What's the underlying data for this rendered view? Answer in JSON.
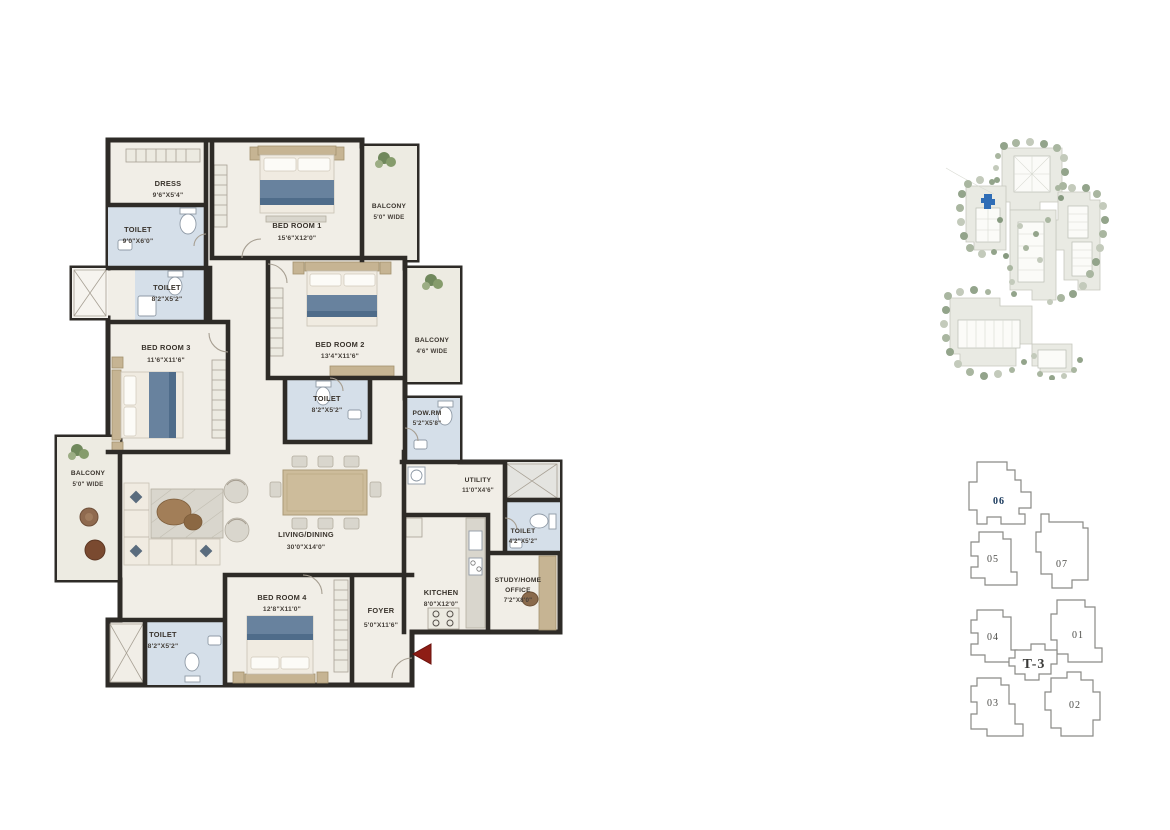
{
  "floorplan": {
    "rooms": [
      {
        "name": "DRESS",
        "dims": "9'6\"X5'4\""
      },
      {
        "name": "TOILET",
        "dims": "9'0\"X6'0\""
      },
      {
        "name": "BED ROOM 1",
        "dims": "15'6\"X12'0\""
      },
      {
        "name": "BALCONY",
        "dims": "5'0\" WIDE"
      },
      {
        "name": "TOILET",
        "dims": "8'2\"X5'2\""
      },
      {
        "name": "BED ROOM 3",
        "dims": "11'6\"X11'6\""
      },
      {
        "name": "BED ROOM 2",
        "dims": "13'4\"X11'6\""
      },
      {
        "name": "BALCONY",
        "dims": "4'6\" WIDE"
      },
      {
        "name": "TOILET",
        "dims": "8'2\"X5'2\""
      },
      {
        "name": "POW.RM",
        "dims": "5'2\"X5'8\""
      },
      {
        "name": "BALCONY",
        "dims": "5'0\" WIDE"
      },
      {
        "name": "LIVING/DINING",
        "dims": "30'0\"X14'0\""
      },
      {
        "name": "BED ROOM 4",
        "dims": "12'8\"X11'0\""
      },
      {
        "name": "TOILET",
        "dims": "8'2\"X5'2\""
      },
      {
        "name": "FOYER",
        "dims": "5'0\"X11'6\""
      },
      {
        "name": "KITCHEN",
        "dims": "8'0\"X12'0\""
      },
      {
        "name": "UTILITY",
        "dims": "11'0\"X4'6\""
      },
      {
        "name": "TOILET",
        "dims": "4'2\"X5'2\""
      },
      {
        "name": "STUDY/HOME OFFICE",
        "name_line1": "STUDY/HOME",
        "name_line2": "OFFICE",
        "dims": "7'2\"X8'0\""
      }
    ]
  },
  "keyplan": {
    "tower_label": "T-3",
    "units": [
      {
        "label": "06",
        "highlighted": true
      },
      {
        "label": "05",
        "highlighted": false
      },
      {
        "label": "07",
        "highlighted": false
      },
      {
        "label": "04",
        "highlighted": false
      },
      {
        "label": "01",
        "highlighted": false
      },
      {
        "label": "03",
        "highlighted": false
      },
      {
        "label": "02",
        "highlighted": false
      }
    ]
  },
  "colors": {
    "wall": "#2e2b27",
    "floor": "#f1eee7",
    "bath_floor": "#d5dfe9",
    "balcony_floor": "#edebe2",
    "wood": "#c6b493",
    "bed_blanket": "#68829e",
    "accent_blue": "#2f6db6",
    "entry_red": "#8e1d15",
    "label_text": "#39332c"
  }
}
